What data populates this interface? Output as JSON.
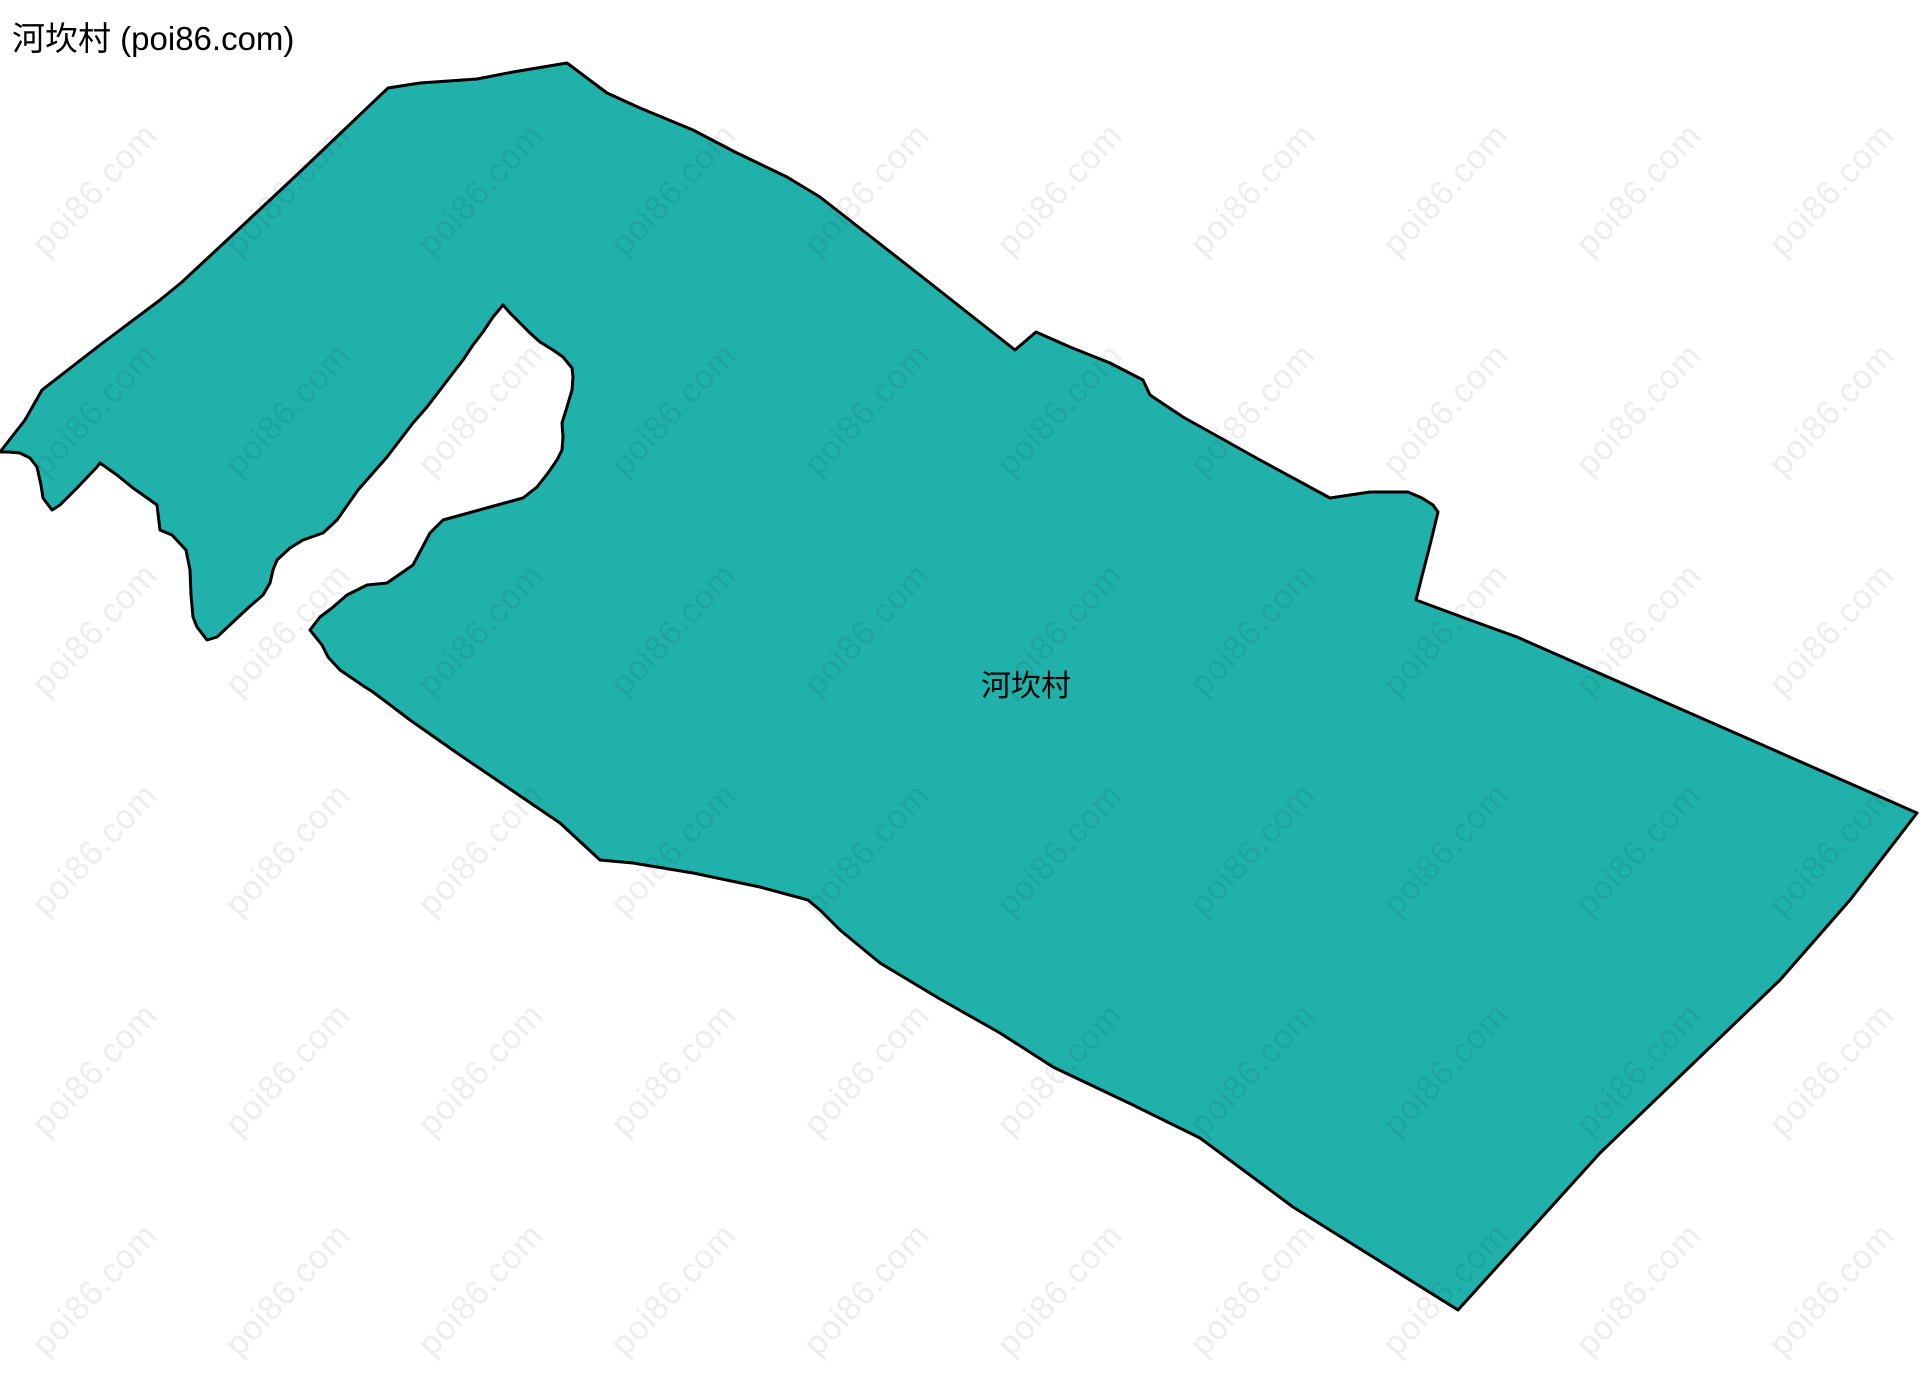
{
  "title": "河坎村 (poi86.com)",
  "canvas": {
    "width": 1920,
    "height": 1375,
    "background_color": "#FFFFFF"
  },
  "map": {
    "label": "河坎村",
    "region_name": "河坎村",
    "fill_color": "#20B2AA",
    "border_color": "#000000",
    "label_x": 1026,
    "label_y": 683,
    "polygon": [
      [
        567,
        63
      ],
      [
        607,
        93
      ],
      [
        640,
        108
      ],
      [
        693,
        130
      ],
      [
        735,
        152
      ],
      [
        787,
        177
      ],
      [
        820,
        197
      ],
      [
        875,
        240
      ],
      [
        930,
        283
      ],
      [
        968,
        313
      ],
      [
        1015,
        350
      ],
      [
        1036,
        332
      ],
      [
        1070,
        347
      ],
      [
        1110,
        363
      ],
      [
        1143,
        380
      ],
      [
        1150,
        395
      ],
      [
        1183,
        417
      ],
      [
        1260,
        460
      ],
      [
        1330,
        498
      ],
      [
        1370,
        492
      ],
      [
        1408,
        492
      ],
      [
        1422,
        498
      ],
      [
        1433,
        505
      ],
      [
        1438,
        512
      ],
      [
        1430,
        545
      ],
      [
        1421,
        580
      ],
      [
        1416,
        600
      ],
      [
        1470,
        620
      ],
      [
        1517,
        637
      ],
      [
        1917,
        813
      ],
      [
        1850,
        900
      ],
      [
        1780,
        980
      ],
      [
        1600,
        1153
      ],
      [
        1458,
        1310
      ],
      [
        1293,
        1207
      ],
      [
        1200,
        1138
      ],
      [
        1133,
        1105
      ],
      [
        1053,
        1067
      ],
      [
        1000,
        1033
      ],
      [
        940,
        999
      ],
      [
        880,
        963
      ],
      [
        840,
        930
      ],
      [
        820,
        910
      ],
      [
        808,
        900
      ],
      [
        760,
        887
      ],
      [
        693,
        873
      ],
      [
        633,
        863
      ],
      [
        600,
        860
      ],
      [
        560,
        823
      ],
      [
        457,
        753
      ],
      [
        410,
        720
      ],
      [
        373,
        692
      ],
      [
        365,
        687
      ],
      [
        340,
        670
      ],
      [
        328,
        657
      ],
      [
        322,
        645
      ],
      [
        310,
        630
      ],
      [
        320,
        617
      ],
      [
        332,
        608
      ],
      [
        347,
        595
      ],
      [
        367,
        585
      ],
      [
        387,
        583
      ],
      [
        413,
        565
      ],
      [
        430,
        533
      ],
      [
        443,
        520
      ],
      [
        490,
        507
      ],
      [
        523,
        498
      ],
      [
        537,
        487
      ],
      [
        548,
        473
      ],
      [
        557,
        460
      ],
      [
        562,
        450
      ],
      [
        563,
        437
      ],
      [
        562,
        423
      ],
      [
        567,
        407
      ],
      [
        572,
        390
      ],
      [
        573,
        377
      ],
      [
        572,
        368
      ],
      [
        563,
        357
      ],
      [
        553,
        350
      ],
      [
        540,
        342
      ],
      [
        530,
        333
      ],
      [
        520,
        323
      ],
      [
        510,
        313
      ],
      [
        503,
        305
      ],
      [
        493,
        317
      ],
      [
        483,
        332
      ],
      [
        473,
        345
      ],
      [
        463,
        360
      ],
      [
        453,
        373
      ],
      [
        440,
        390
      ],
      [
        427,
        407
      ],
      [
        413,
        423
      ],
      [
        400,
        440
      ],
      [
        387,
        457
      ],
      [
        380,
        465
      ],
      [
        358,
        490
      ],
      [
        337,
        520
      ],
      [
        323,
        533
      ],
      [
        303,
        540
      ],
      [
        290,
        548
      ],
      [
        277,
        560
      ],
      [
        273,
        570
      ],
      [
        270,
        583
      ],
      [
        263,
        595
      ],
      [
        248,
        608
      ],
      [
        233,
        622
      ],
      [
        217,
        637
      ],
      [
        207,
        640
      ],
      [
        197,
        627
      ],
      [
        193,
        617
      ],
      [
        191,
        595
      ],
      [
        190,
        570
      ],
      [
        186,
        550
      ],
      [
        172,
        535
      ],
      [
        160,
        530
      ],
      [
        157,
        505
      ],
      [
        143,
        495
      ],
      [
        133,
        488
      ],
      [
        117,
        475
      ],
      [
        100,
        463
      ],
      [
        97,
        467
      ],
      [
        77,
        488
      ],
      [
        60,
        505
      ],
      [
        52,
        510
      ],
      [
        43,
        498
      ],
      [
        41,
        485
      ],
      [
        37,
        467
      ],
      [
        30,
        458
      ],
      [
        20,
        453
      ],
      [
        8,
        452
      ],
      [
        0,
        452
      ],
      [
        25,
        420
      ],
      [
        42,
        390
      ],
      [
        100,
        345
      ],
      [
        160,
        300
      ],
      [
        182,
        282
      ],
      [
        240,
        228
      ],
      [
        302,
        170
      ],
      [
        388,
        88
      ],
      [
        420,
        83
      ],
      [
        477,
        79
      ],
      [
        513,
        72
      ]
    ]
  },
  "watermark": {
    "text": "poi86.com",
    "color": "rgba(0,0,0,0.07)",
    "rotation_deg": -47,
    "font_size": 34,
    "grid": {
      "start_x": 95,
      "start_y": 190,
      "step_x": 193,
      "step_y": 220,
      "cols": 10,
      "rows": 6
    }
  }
}
